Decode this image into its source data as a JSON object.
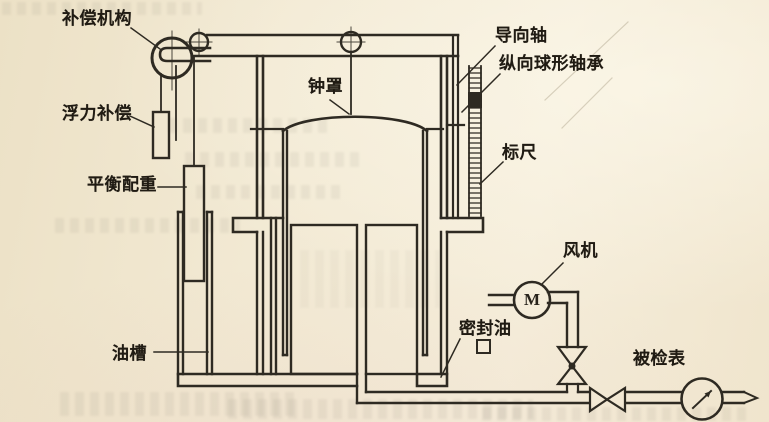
{
  "diagram": {
    "labels": {
      "compensation_mechanism": "补偿机构",
      "buoyancy_compensation": "浮力补偿",
      "balance_weight": "平衡配重",
      "oil_tank": "油槽",
      "bell_jar": "钟罩",
      "guide_shaft": "导向轴",
      "longitudinal_spherical_bearing": "纵向球形轴承",
      "scale_ruler": "标尺",
      "fan": "风机",
      "sealing_oil": "密封油",
      "meter_under_test": "被检表"
    },
    "motor_symbol": "M",
    "colors": {
      "paper": "#f2e9d3",
      "line": "#2e2a22",
      "text": "#201b13"
    }
  }
}
